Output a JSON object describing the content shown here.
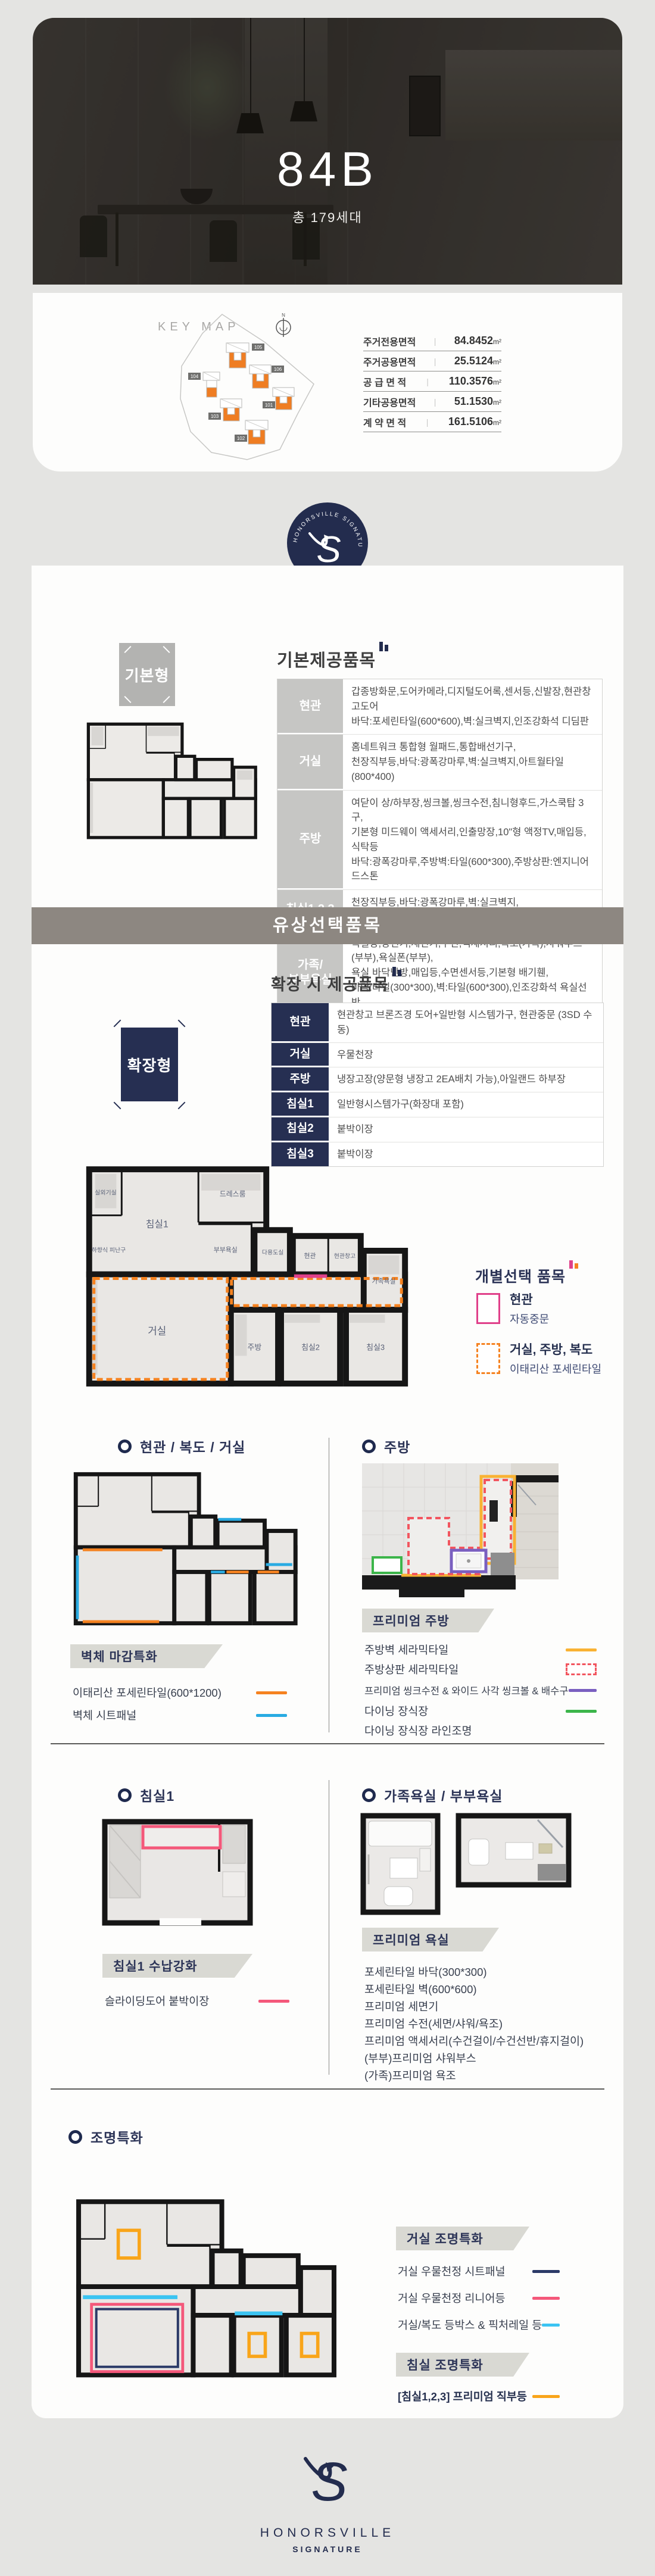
{
  "hero": {
    "unit": "84B",
    "households": "총 179세대"
  },
  "keymap": {
    "title": "KEY MAP",
    "north": "N",
    "buildings": {
      "b105": "105",
      "b106": "106",
      "b104": "104",
      "b101": "101",
      "b103": "103",
      "b102": "102"
    },
    "areas": [
      {
        "label": "주거전용면적",
        "value": "84.8452",
        "unit": "m²"
      },
      {
        "label": "주거공용면적",
        "value": "25.5124",
        "unit": "m²"
      },
      {
        "label": "공 급 면 적",
        "value": "110.3576",
        "unit": "m²"
      },
      {
        "label": "기타공용면적",
        "value": "51.1530",
        "unit": "m²"
      },
      {
        "label": "계 약 면 적",
        "value": "161.5106",
        "unit": "m²"
      }
    ]
  },
  "logo": {
    "brand": "HONORSVILLE",
    "sub": "SIGNATURE",
    "monogram": "S",
    "arc": "HONORSVILLE SIGNATURE"
  },
  "basic": {
    "badge": "기본형",
    "title": "기본제공품목",
    "rows": [
      {
        "cat": "현관",
        "desc": "갑종방화문,도어카메라,디지털도어록,센서등,신발장,현관창고도어\n바닥:포세린타일(600*600),벽:실크벽지,인조강화석 디딤판"
      },
      {
        "cat": "거실",
        "desc": "홈네트워크 통합형 월패드,통합배선기구,\n천장직부등,바닥:광폭강마루,벽:실크벽지,아트월타일(800*400)"
      },
      {
        "cat": "주방",
        "desc": "여닫이 상/하부장,씽크볼,씽크수전,침니형후드,가스쿡탑 3구,\n기본형 미드웨이 액세서리,인출망장,10\"형 액정TV,매입등,식탁등\n바닥:광폭강마루,주방벽:타일(600*300),주방상판:엔지니어드스톤"
      },
      {
        "cat": "침실1,2,3",
        "desc": "천장직부등,바닥:광폭강마루,벽:실크벽지,\n드레스룸도어(침실1)"
      },
      {
        "cat": "가족/\n부부욕실",
        "desc": "욕실장,양변기,세면기,수전,액세서리,욕조(가족),샤워부스(부부),욕실폰(부부),\n욕실 바닥난방,매입등,수면센서등,기본형 배기휀,\n바닥:타일(300*300),벽:타일(600*300),인조강화석 욕실선반"
      }
    ]
  },
  "paid_banner": "유상선택품목",
  "expand": {
    "badge": "확장형",
    "title": "확장 시 제공품목",
    "rows": [
      {
        "cat": "현관",
        "desc": "현관창고 브론즈경 도어+일반형 시스템가구, 현관중문 (3SD 수동)"
      },
      {
        "cat": "거실",
        "desc": "우물천장"
      },
      {
        "cat": "주방",
        "desc": "냉장고장(양문형 냉장고 2EA배치 가능),아일랜드 하부장"
      },
      {
        "cat": "침실1",
        "desc": "일반형시스템가구(화장대 포함)"
      },
      {
        "cat": "침실2",
        "desc": "붙박이장"
      },
      {
        "cat": "침실3",
        "desc": "붙박이장"
      }
    ]
  },
  "plan_rooms": {
    "outdoor": "실외기실",
    "bed1": "침실1",
    "dress": "드레스룸",
    "escape": "하향식 피난구",
    "bath2": "부부욕실",
    "utility": "다용도실",
    "entrance": "현관",
    "storage": "현관창고",
    "bath1": "가족욕실",
    "living": "거실",
    "kitchen": "주방",
    "bed2": "침실2",
    "bed3": "침실3"
  },
  "individual": {
    "title": "개별선택 품목",
    "items": [
      {
        "label": "현관",
        "desc": "자동중문",
        "color": "#e0408a"
      },
      {
        "label": "거실, 주방, 복도",
        "desc": "이태리산 포세린타일",
        "color": "#f58220"
      }
    ]
  },
  "wall": {
    "heading": "현관 / 복도 / 거실",
    "tag": "벽체 마감특화",
    "legend": [
      {
        "label": "이태리산 포세린타일(600*1200)",
        "color": "#f58220"
      },
      {
        "label": "벽체 시트패널",
        "color": "#29abe2"
      }
    ]
  },
  "kitchen": {
    "heading": "주방",
    "tag": "프리미엄 주방",
    "legend": [
      {
        "label": "주방벽 세라믹타일",
        "color": "#f9b233"
      },
      {
        "label": "주방상판 세라믹타일",
        "color": "#f2555f"
      },
      {
        "label": "프리미엄 씽크수전 & 와이드 사각 씽크볼 & 배수구",
        "color": "#7a5fc0"
      },
      {
        "label": "다이닝 장식장",
        "color": "#3cb54a"
      },
      {
        "label": "다이닝 장식장 라인조명",
        "color": ""
      }
    ]
  },
  "bed1sec": {
    "heading": "침실1",
    "tag": "침실1 수납강화",
    "legend": [
      {
        "label": "슬라이딩도어 붙박이장",
        "color": "#f4587a"
      }
    ]
  },
  "bath": {
    "heading": "가족욕실 / 부부욕실",
    "tag": "프리미엄 욕실",
    "items": [
      "포세린타일 바닥(300*300)",
      "포세린타일 벽(600*600)",
      "프리미엄 세면기",
      "프리미엄 수전(세면/샤워/욕조)",
      "프리미엄 액세서리(수건걸이/수건선반/휴지걸이)",
      "(부부)프리미엄 샤워부스",
      "(가족)프리미엄 욕조"
    ]
  },
  "light": {
    "heading": "조명특화",
    "living_tag": "거실 조명특화",
    "living_legend": [
      {
        "label": "거실 우물천정 시트패널",
        "color": "#2b3a67"
      },
      {
        "label": "거실 우물천정 리니어등",
        "color": "#f4587a"
      },
      {
        "label": "거실/복도 등박스 & 픽처레일 등",
        "color": "#3bc4f2"
      }
    ],
    "bed_tag": "침실 조명특화",
    "bed_legend": [
      {
        "label": "[침실1,2,3] 프리미엄 직부등",
        "color": "#f9a51a"
      }
    ]
  },
  "footer": {
    "brand": "HONORSVILLE",
    "sub": "SIGNATURE"
  }
}
